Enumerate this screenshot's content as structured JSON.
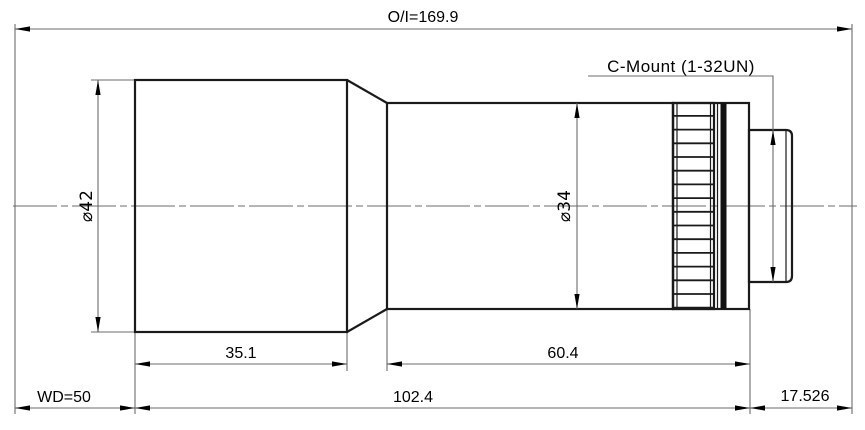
{
  "drawing": {
    "labels": {
      "overall_distance": "O/I=169.9",
      "mount": "C-Mount (1-32UN)",
      "working_distance": "WD=50"
    },
    "diameters": {
      "front_barrel": "⌀42",
      "main_barrel": "⌀34"
    },
    "lengths": {
      "front_barrel": "35.1",
      "rear_barrel": "60.4",
      "lens_body": "102.4",
      "flange_to_image": "17.526"
    },
    "colors": {
      "outline": "#1a1a1a",
      "dimension_line": "#6b6b6b",
      "text": "#000000",
      "background": "#ffffff"
    }
  }
}
